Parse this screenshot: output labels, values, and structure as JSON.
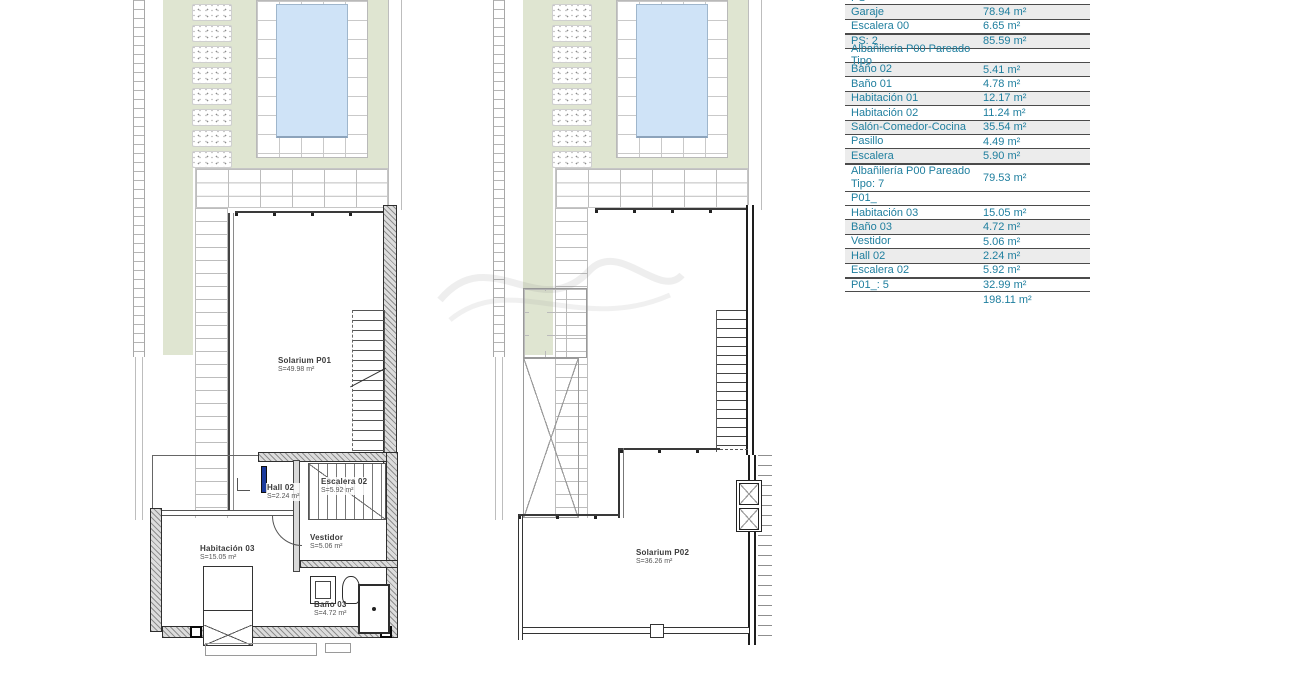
{
  "drawing": {
    "sheet_type": "architectural-floor-plan",
    "colors": {
      "accent_text": "#1E7E9E",
      "garden_green": "#DFE5D1",
      "pool_water": "#CFE3F7",
      "row_shade": "#ECECEC",
      "line_dark": "#4B4B4B",
      "door_blue": "#1A3A9C"
    },
    "plans": {
      "left": {
        "solarium": {
          "name": "Solarium P01",
          "area": "S=49.98 m²"
        },
        "hall": {
          "name": "Hall 02",
          "area": "S=2.24 m²"
        },
        "escalera": {
          "name": "Escalera 02",
          "area": "S=5.92 m²"
        },
        "vestidor": {
          "name": "Vestidor",
          "area": "S=5.06 m²"
        },
        "habitacion": {
          "name": "Habitación 03",
          "area": "S=15.05 m²"
        },
        "bano": {
          "name": "Baño 03",
          "area": "S=4.72 m²"
        }
      },
      "right": {
        "solarium": {
          "name": "Solarium P02",
          "area": "S=36.26 m²"
        }
      }
    },
    "schedule": {
      "unit": "m²",
      "rows": [
        {
          "label": "PS",
          "value": "",
          "type": "header-cut",
          "shaded": false
        },
        {
          "label": "Garaje",
          "value": "78.94 m²",
          "type": "data",
          "shaded": true
        },
        {
          "label": "Escalera 00",
          "value": "6.65 m²",
          "type": "data",
          "shaded": false
        },
        {
          "label": "PS: 2",
          "value": "85.59 m²",
          "type": "total",
          "shaded": true
        },
        {
          "label": "Albañilería P00 Pareado Tipo",
          "value": "",
          "type": "header",
          "shaded": false
        },
        {
          "label": "Baño 02",
          "value": "5.41 m²",
          "type": "data",
          "shaded": true
        },
        {
          "label": "Baño 01",
          "value": "4.78 m²",
          "type": "data",
          "shaded": false
        },
        {
          "label": "Habitación 01",
          "value": "12.17 m²",
          "type": "data",
          "shaded": true
        },
        {
          "label": "Habitación 02",
          "value": "11.24 m²",
          "type": "data",
          "shaded": false
        },
        {
          "label": "Salón-Comedor-Cocina",
          "value": "35.54 m²",
          "type": "data",
          "shaded": true
        },
        {
          "label": "Pasillo",
          "value": "4.49 m²",
          "type": "data",
          "shaded": false
        },
        {
          "label": "Escalera",
          "value": "5.90 m²",
          "type": "data",
          "shaded": true
        },
        {
          "label": "Albañilería P00 Pareado Tipo: 7",
          "value": "79.53 m²",
          "type": "total-tall",
          "shaded": false
        },
        {
          "label": "P01_",
          "value": "",
          "type": "header",
          "shaded": false
        },
        {
          "label": "Habitación 03",
          "value": "15.05 m²",
          "type": "data",
          "shaded": false
        },
        {
          "label": "Baño 03",
          "value": "4.72 m²",
          "type": "data",
          "shaded": true
        },
        {
          "label": "Vestidor",
          "value": "5.06 m²",
          "type": "data",
          "shaded": false
        },
        {
          "label": "Hall 02",
          "value": "2.24 m²",
          "type": "data",
          "shaded": true
        },
        {
          "label": "Escalera 02",
          "value": "5.92 m²",
          "type": "data",
          "shaded": false
        },
        {
          "label": "P01_: 5",
          "value": "32.99 m²",
          "type": "total",
          "shaded": false
        },
        {
          "label": "",
          "value": "198.11 m²",
          "type": "grand",
          "shaded": false
        }
      ]
    }
  }
}
